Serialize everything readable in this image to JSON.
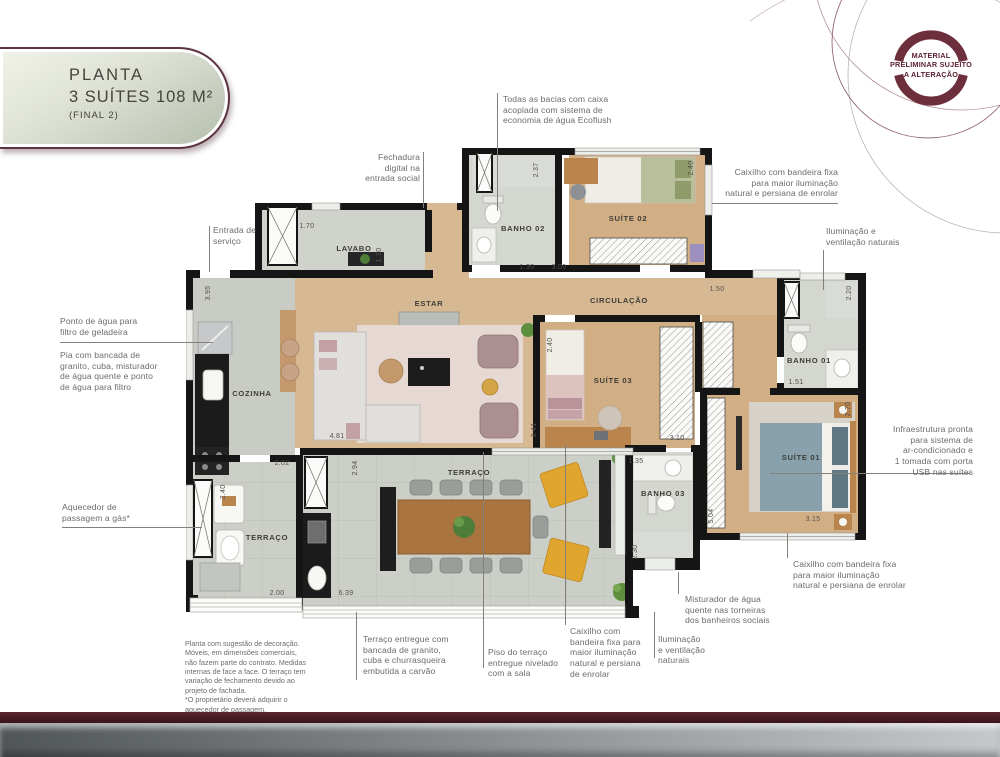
{
  "title": {
    "line1": "PLANTA",
    "line2": "3 SUÍTES 108 M²",
    "line3": "(FINAL 2)"
  },
  "stamp": {
    "text": "MATERIAL\nPRELIMINAR SUJEITO\nA ALTERAÇÃO"
  },
  "plan": {
    "rooms": [
      {
        "id": "lavabo",
        "label": "LAVABO"
      },
      {
        "id": "banho-02",
        "label": "BANHO 02"
      },
      {
        "id": "suite-02",
        "label": "SUÍTE 02"
      },
      {
        "id": "estar",
        "label": "ESTAR"
      },
      {
        "id": "circulacao",
        "label": "CIRCULAÇÃO"
      },
      {
        "id": "banho-01",
        "label": "BANHO 01"
      },
      {
        "id": "suite-03",
        "label": "SUÍTE 03"
      },
      {
        "id": "suite-01",
        "label": "SUÍTE 01"
      },
      {
        "id": "cozinha",
        "label": "COZINHA"
      },
      {
        "id": "terraco-servico",
        "label": "TERRAÇO"
      },
      {
        "id": "terraco",
        "label": "TERRAÇO"
      },
      {
        "id": "banho-03",
        "label": "BANHO 03"
      }
    ],
    "dimensions": [
      {
        "id": "cozinha-altura",
        "v": "3.95"
      },
      {
        "id": "lavabo-largura",
        "v": "1.70"
      },
      {
        "id": "lavabo-altura",
        "v": "1.10"
      },
      {
        "id": "banho02-altura",
        "v": "2.37"
      },
      {
        "id": "banho02-largura",
        "v": "1.30"
      },
      {
        "id": "suite02-largura",
        "v": "3.00"
      },
      {
        "id": "suite02-altura",
        "v": "2.40"
      },
      {
        "id": "circulacao-largura",
        "v": "1.50"
      },
      {
        "id": "banho01-altura",
        "v": "2.20"
      },
      {
        "id": "banho01-largura",
        "v": "1.51"
      },
      {
        "id": "suite01-altura",
        "v": "2.70"
      },
      {
        "id": "suite01-largura",
        "v": "3.15"
      },
      {
        "id": "corredor-altura",
        "v": "5.04"
      },
      {
        "id": "suite03-altura",
        "v": "2.40"
      },
      {
        "id": "suite03-largura",
        "v": "3.10"
      },
      {
        "id": "estar-altura",
        "v": "3.41"
      },
      {
        "id": "estar-largura",
        "v": "4.81"
      },
      {
        "id": "cozinha-largura",
        "v": "2.02"
      },
      {
        "id": "terraco-altura",
        "v": "2.94"
      },
      {
        "id": "terraco-servico-altura",
        "v": "2.40"
      },
      {
        "id": "terraco-servico-largura",
        "v": "2.00"
      },
      {
        "id": "terraco-largura",
        "v": "6.39"
      },
      {
        "id": "banho03-largura",
        "v": "1.35"
      },
      {
        "id": "banho03-altura",
        "v": "2.30"
      }
    ]
  },
  "callouts": {
    "bacias": {
      "text": "Todas as bacias com caixa\nacoplada com sistema de\neconomia de água Ecoflush"
    },
    "fechadura": {
      "text": "Fechadura\ndigital na\nentrada social"
    },
    "caixilho_top_right": {
      "text": "Caixilho com bandeira fixa\npara maior iluminação\nnatural e persiana de enrolar"
    },
    "iluminacao_right": {
      "text": "Iluminação e\nventilação naturais"
    },
    "entrada_servico": {
      "text": "Entrada de\nserviço"
    },
    "ponto_agua": {
      "text": "Ponto de água para\nfiltro de geladeira"
    },
    "pia_bancada": {
      "text": "Pia com bancada de\ngranito, cuba, misturador\nde água quente e ponto\nde água para filtro"
    },
    "aquecedor": {
      "text": "Aquecedor de\npassagem a gás*"
    },
    "infraestrutura": {
      "text": "Infraestrutura pronta\npara sistema de\nar-condicionado e\n1 tomada com porta\nUSB nas suítes"
    },
    "caixilho_bottom_right": {
      "text": "Caixilho com bandeira fixa\npara maior iluminação\nnatural e persiana de enrolar"
    },
    "misturador": {
      "text": "Misturador de água\nquente nas torneiras\ndos banheiros sociais"
    },
    "iluminacao_bottom": {
      "text": "Iluminação\ne ventilação\nnaturais"
    },
    "terraco_entregue": {
      "text": "Terraço entregue com\nbancada de granito,\ncuba e churrasqueira\nembutida a carvão"
    },
    "piso_terraco": {
      "text": "Piso do terraço\nentregue nivelado\ncom a sala"
    },
    "caixilho_bottom_mid": {
      "text": "Caixilho com\nbandeira fixa para\nmaior iluminação\nnatural e persiana\nde enrolar"
    }
  },
  "disclaimer": "Planta com sugestão de decoração.\nMóveis, em dimensões comerciais,\nnão fazem parte do contrato. Medidas\ninternas de face a face. O terraço tem\nvariação de fechamento devido ao\nprojeto de fachada.\n*O proprietário deverá adquirir o\naquecedor de passagem.",
  "colors": {
    "accent_maroon": "#5d2533",
    "stamp_arc": "#6e2f3c",
    "bar_maroon": "#471a25",
    "bar_silver_left": "#505558",
    "bar_silver_right": "#c6c9cb",
    "pill_fill": "#d9ded1",
    "wall": "#151515",
    "wood_floor": "#d6b893",
    "tile_floor": "#cbcfc7"
  }
}
